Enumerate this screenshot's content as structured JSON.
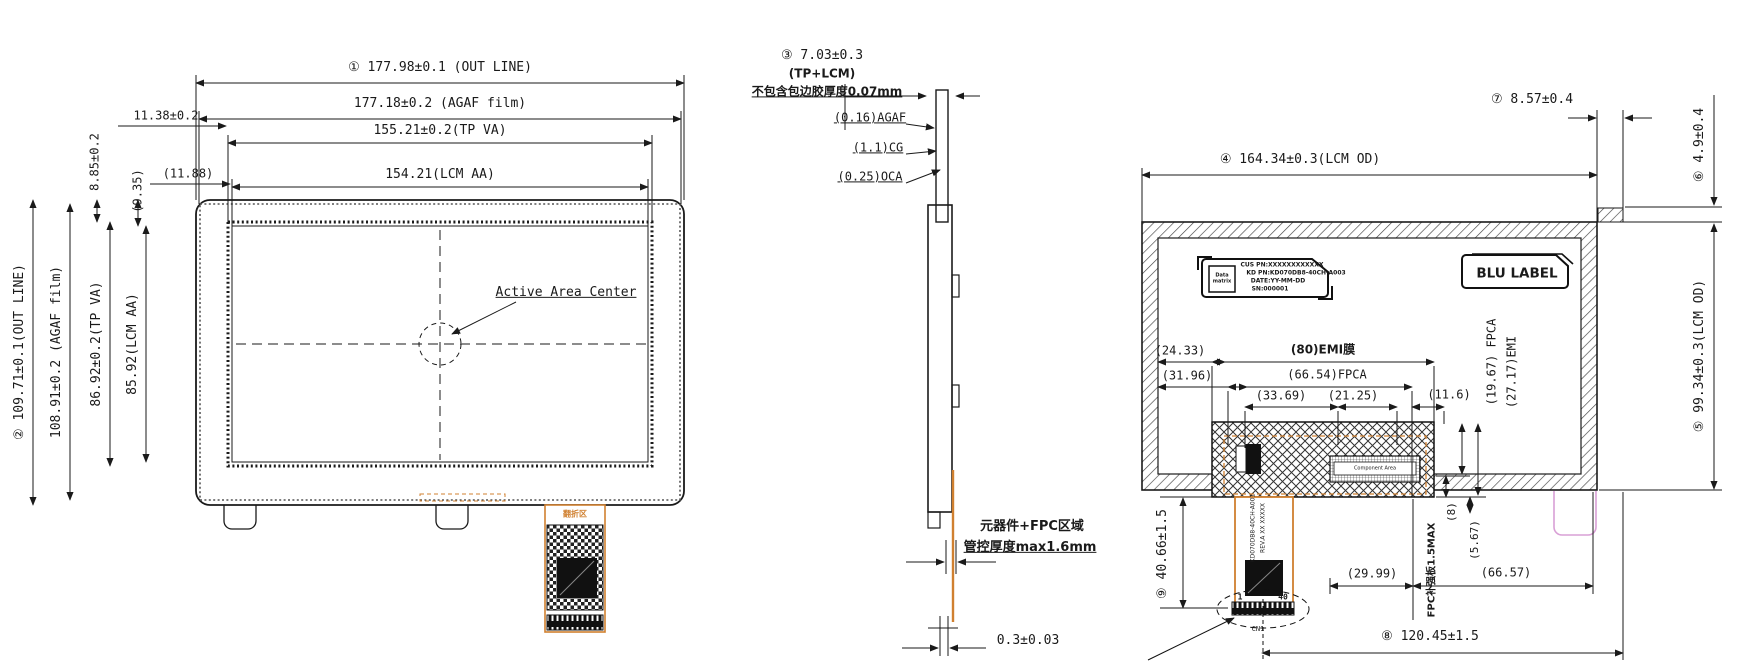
{
  "colors": {
    "line": "#1a1a1a",
    "fpc_orange": "#d08030",
    "tab_pink": "#d9a0d6"
  },
  "front": {
    "d1": "① 177.98±0.1 (OUT LINE)",
    "d2": "177.18±0.2 (AGAF film)",
    "d3": "155.21±0.2(TP VA)",
    "d4": "154.21(LCM AA)",
    "v1": "② 109.71±0.1(OUT LINE)",
    "v2": "108.91±0.2 (AGAF film)",
    "v3": "86.92±0.2(TP VA)",
    "v4": "85.92(LCM AA)",
    "m1": "8.85±0.2",
    "m2": "(9.35)",
    "m3": "11.38±0.2",
    "m4": "(11.88)",
    "center_label": "Active Area Center",
    "fpc_text": "翻折区"
  },
  "side": {
    "t1": "③ 7.03±0.3",
    "t2": "(TP+LCM)",
    "t3": "不包含包边胶厚度0.07mm",
    "s1": "(0.16)AGAF",
    "s2": "(1.1)CG",
    "s3": "(0.25)OCA",
    "note1": "元器件+FPC区域",
    "note2": "管控厚度max1.6mm",
    "b1": "0.3±0.03"
  },
  "back": {
    "d_top": "④ 164.34±0.3(LCM OD)",
    "d5": "⑤ 99.34±0.3(LCM OD)",
    "d6": "⑥ 4.9±0.4",
    "d7": "⑦ 8.57±0.4",
    "d8": "⑧ 120.45±1.5",
    "d9": "⑨ 40.66±1.5",
    "emi": "(80)EMI膜",
    "fpca": "(66.54)FPCA",
    "a1": "(33.69)",
    "a2": "(21.25)",
    "a3": "(11.6)",
    "v1": "(19.67) FPCA",
    "v2": "(27.17)EMI",
    "l1": "(24.33)",
    "l2": "(31.96)",
    "b1": "(29.99)",
    "b2": "(66.57)",
    "stiffener": "FPC补强板1.5MAX",
    "g1": "(8)",
    "g2": "(5.67)",
    "blu": "BLU LABEL",
    "component_area": "Component Area",
    "label": {
      "dm": "Data matrix",
      "l1": "CUS PN:XXXXXXXXXXXX",
      "l2": "KD PN:KD070DB8-40CH-A003",
      "l3": "DATE:YY-MM-DD",
      "l4": "SN:000001"
    },
    "fpc_line1": "KD070DB8-40CH-A001",
    "fpc_line2": "REV.A XX XXXXX",
    "pin1": "1",
    "pin40": "40",
    "cn1": "CN1"
  }
}
